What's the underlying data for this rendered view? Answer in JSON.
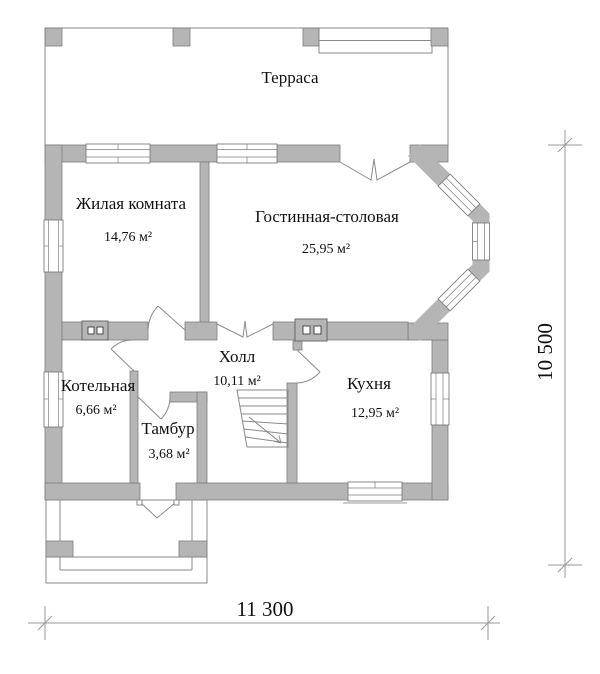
{
  "drawing": {
    "type": "architectural floor plan (first floor)",
    "language": "ru"
  },
  "colors": {
    "wall": "#b5b5b5",
    "wall_outline": "#7d7d7d",
    "line": "#8a8a8a",
    "dimension_line": "#9a9a9a",
    "text": "#111111",
    "background": "#ffffff"
  },
  "rooms": [
    {
      "name": "Терраса",
      "area": ""
    },
    {
      "name": "Жилая комната",
      "area": "14,76 м²"
    },
    {
      "name": "Гостинная-столовая",
      "area": "25,95 м²"
    },
    {
      "name": "Холл",
      "area": "10,11 м²"
    },
    {
      "name": "Котельная",
      "area": "6,66 м²"
    },
    {
      "name": "Тамбур",
      "area": "3,68 м²"
    },
    {
      "name": "Кухня",
      "area": "12,95 м²"
    }
  ],
  "dimensions": {
    "width_label": "11 300",
    "height_label": "10 500"
  }
}
